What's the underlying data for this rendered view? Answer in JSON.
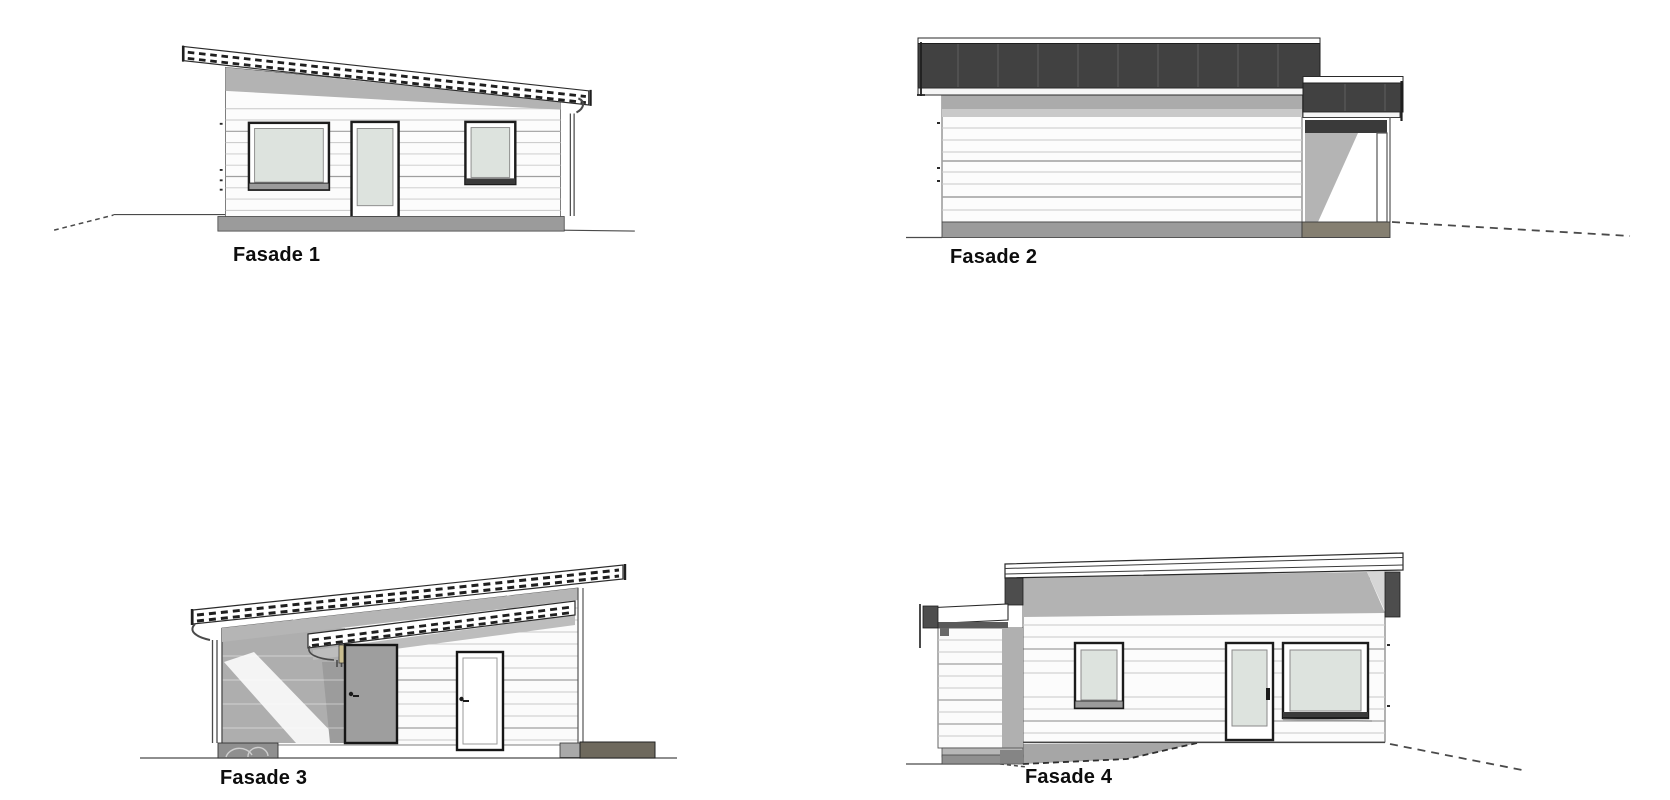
{
  "page": {
    "background": "#ffffff",
    "description": "Architectural facade elevation sheet with four drawings"
  },
  "drawings": [
    {
      "id": "fasade-1",
      "label": "Fasade 1",
      "view": "front elevation, shed roof sloping down to the right, two windows and one glazed door"
    },
    {
      "id": "fasade-2",
      "label": "Fasade 2",
      "view": "side elevation, dark seamed roof panel, blank siding wall, open carport annex at right"
    },
    {
      "id": "fasade-3",
      "label": "Fasade 3",
      "view": "rear elevation, shed roof sloping up to the right, carport bay, gray door and white door"
    },
    {
      "id": "fasade-4",
      "label": "Fasade 4",
      "view": "side elevation with annex at left, small window, glazed door and large window"
    }
  ],
  "colors": {
    "line": "#333333",
    "wall": "#fcfcfc",
    "siding_line": "#c8c8c8",
    "siding_line_dark": "#9f9f9f",
    "roof_dark": "#414141",
    "shadow": "#b3b3b3",
    "shadow_light": "#d6d6d6",
    "glass": "#dde3de",
    "foundation": "#9b9b9b",
    "foundation_brown": "#6e695d",
    "annex_foundation_brown": "#857f71",
    "door_gray": "#9e9e9e",
    "trim_tan": "#c9bd8f",
    "label_color": "#0d0d0d"
  }
}
